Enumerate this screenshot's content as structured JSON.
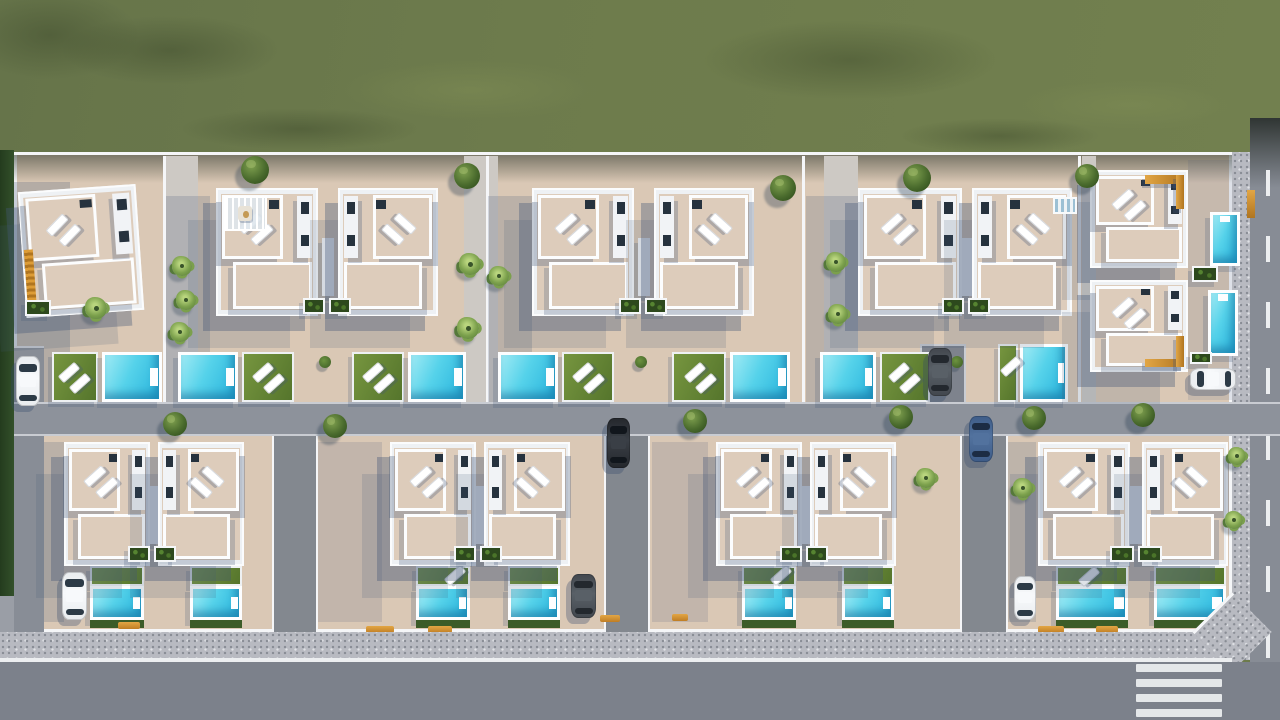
{
  "meta": {
    "title": "Aerial 3D architectural render of a residential villa development",
    "description": "Top-down render: green field above a walled plot with two rows of white villas, rooftop terraces with sun loungers, orange exterior stairs, planters, turquoise pools, lawns, internal roads, parked cars, perimeter sidewalk, asphalt road with zebra crosswalk at bottom right",
    "visible_text": ""
  },
  "palette": {
    "grass": "#6d7b4c",
    "grassDark": "rgba(40,52,28,0.32)",
    "grassLight": "rgba(126,140,84,0.55)",
    "plot": "#dac8b5",
    "wallWhite": "#f5f6f8",
    "villaWhite": "#eef1f4",
    "terrace": "#ddccbb",
    "darkSlot": "#26323e",
    "roadMid": "#8d929b",
    "roadAlley": "#83888f",
    "roadMain": "#7c818b",
    "roadRight": "#878c95",
    "roadLeft": "#888d96",
    "sidewalk": "#b8bac1",
    "curb": "#c9ccd2",
    "whiteLine": "#eceef0",
    "poolLight": "#9feaf4",
    "poolMid": "#55d2ea",
    "poolDeep": "#28b3dc",
    "lawnLight": "#76953f",
    "lawnDark": "#55752c",
    "hedge": "#33502a",
    "hedgeRow": "#3c5c28",
    "orange": "#dd9c36",
    "orangeDark": "#b07520",
    "planter": "#2d491d",
    "planterDot": "#568431",
    "castShadow": "rgba(66,86,120,0.36)",
    "castShadowFar": "rgba(66,86,120,0.17)",
    "softShadow": "rgba(66,86,120,0.22)",
    "treeRoundIn": "#7fa04f",
    "treeRoundOut": "#32501d",
    "palmIn": "#b9d57e",
    "palmMid": "#7ba04c",
    "palmOut": "#55793a",
    "cars": {
      "white": [
        "#e9ecef",
        "#f7f9fb",
        "#2c3a46"
      ],
      "black": [
        "#24272c",
        "#3a3f46",
        "#11161c"
      ],
      "blue": [
        "#3e5c88",
        "#52729e",
        "#1c2c44"
      ],
      "darkgray": [
        "#42474e",
        "#596067",
        "#23282e"
      ]
    }
  },
  "scene": {
    "grass": {
      "x": 0,
      "y": 0,
      "w": 1280,
      "h": 168
    },
    "grass_blotches": [
      [
        60,
        15,
        220,
        70,
        "d"
      ],
      [
        340,
        60,
        260,
        60,
        "l"
      ],
      [
        700,
        20,
        300,
        80,
        "d"
      ],
      [
        1020,
        80,
        220,
        50,
        "l"
      ],
      [
        180,
        108,
        240,
        42,
        "d"
      ],
      [
        900,
        118,
        200,
        36,
        "d"
      ],
      [
        -40,
        -10,
        180,
        90,
        "d"
      ]
    ],
    "right_road": {
      "x": 1250,
      "y": 118,
      "w": 30,
      "h": 602
    },
    "right_road_dashes": {
      "x": 1266,
      "w": 4,
      "len": 26,
      "gap": 40,
      "y0": 170,
      "y1": 640
    },
    "right_sidewalk": {
      "x": 1232,
      "y": 152,
      "w": 18,
      "h": 480
    },
    "left_hedge": {
      "x": 0,
      "y": 150,
      "w": 14,
      "h": 446
    },
    "left_below": {
      "x": 0,
      "y": 596,
      "w": 14,
      "h": 40
    },
    "plot": {
      "x": 14,
      "y": 152,
      "w": 1218,
      "h": 480
    },
    "divider_walls": [
      [
        163,
        156,
        3,
        246
      ],
      [
        486,
        156,
        3,
        246
      ],
      [
        802,
        156,
        3,
        246
      ],
      [
        1078,
        156,
        3,
        246
      ]
    ],
    "pavements": [
      [
        166,
        156,
        32,
        246
      ],
      [
        464,
        156,
        34,
        246
      ],
      [
        824,
        156,
        34,
        246
      ],
      [
        1082,
        156,
        14,
        246
      ]
    ],
    "shadow_rects": [
      [
        14,
        182,
        56,
        224,
        0.25
      ],
      [
        166,
        196,
        44,
        206,
        0.2
      ],
      [
        488,
        196,
        44,
        206,
        0.2
      ],
      [
        806,
        196,
        52,
        206,
        0.2
      ],
      [
        44,
        442,
        20,
        180,
        0.2
      ],
      [
        318,
        442,
        64,
        180,
        0.16
      ],
      [
        652,
        442,
        56,
        180,
        0.16
      ],
      [
        1008,
        442,
        28,
        180,
        0.18
      ],
      [
        14,
        402,
        500,
        34,
        0.15
      ],
      [
        1188,
        160,
        44,
        240,
        0.13
      ]
    ],
    "left_road": {
      "x": 14,
      "y": 346,
      "w": 30,
      "h": 286
    },
    "mid_road": {
      "x": 14,
      "y": 402,
      "w": 1266,
      "h": 34
    },
    "alleys": [
      [
        272,
        436,
        46,
        196
      ],
      [
        604,
        436,
        46,
        196
      ],
      [
        960,
        436,
        48,
        196
      ]
    ],
    "parking_pad": {
      "x": 920,
      "y": 344,
      "w": 46,
      "h": 60
    },
    "lawns": [
      [
        52,
        352,
        46,
        50
      ],
      [
        242,
        352,
        52,
        50
      ],
      [
        352,
        352,
        52,
        50
      ],
      [
        562,
        352,
        52,
        50
      ],
      [
        672,
        352,
        54,
        50
      ],
      [
        880,
        352,
        50,
        50
      ],
      [
        998,
        344,
        20,
        58
      ],
      [
        90,
        566,
        54,
        20
      ],
      [
        190,
        566,
        52,
        20
      ],
      [
        416,
        566,
        54,
        20
      ],
      [
        508,
        566,
        52,
        20
      ],
      [
        742,
        566,
        54,
        20
      ],
      [
        842,
        566,
        52,
        20
      ],
      [
        1056,
        566,
        72,
        20
      ],
      [
        1154,
        566,
        72,
        20
      ]
    ],
    "pools": [
      [
        102,
        352,
        60,
        50,
        "h"
      ],
      [
        178,
        352,
        60,
        50,
        "h"
      ],
      [
        408,
        352,
        58,
        50,
        "h"
      ],
      [
        498,
        352,
        60,
        50,
        "h"
      ],
      [
        730,
        352,
        60,
        50,
        "h"
      ],
      [
        820,
        352,
        56,
        50,
        "h"
      ],
      [
        1020,
        344,
        48,
        58,
        "h"
      ],
      [
        1210,
        212,
        30,
        54,
        "v"
      ],
      [
        1208,
        290,
        30,
        66,
        "v"
      ],
      [
        90,
        586,
        54,
        34,
        "h"
      ],
      [
        190,
        586,
        52,
        34,
        "h"
      ],
      [
        416,
        586,
        54,
        34,
        "h"
      ],
      [
        508,
        586,
        52,
        34,
        "h"
      ],
      [
        742,
        586,
        54,
        34,
        "h"
      ],
      [
        842,
        586,
        52,
        34,
        "h"
      ],
      [
        1056,
        586,
        72,
        34,
        "h"
      ],
      [
        1154,
        586,
        72,
        34,
        "h"
      ]
    ],
    "pool_hedges": [
      [
        90,
        620,
        54,
        8
      ],
      [
        190,
        620,
        52,
        8
      ],
      [
        416,
        620,
        54,
        8
      ],
      [
        508,
        620,
        52,
        8
      ],
      [
        742,
        620,
        54,
        8
      ],
      [
        842,
        620,
        52,
        8
      ],
      [
        1056,
        620,
        72,
        8
      ],
      [
        1154,
        620,
        72,
        8
      ]
    ],
    "lawn_loungers": [
      [
        58,
        366,
        2
      ],
      [
        252,
        366,
        2
      ],
      [
        362,
        366,
        2
      ],
      [
        572,
        366,
        2
      ],
      [
        684,
        366,
        2
      ],
      [
        888,
        366,
        2
      ],
      [
        1000,
        360,
        1
      ],
      [
        444,
        569,
        1
      ],
      [
        770,
        569,
        1
      ],
      [
        1078,
        570,
        1
      ]
    ],
    "villas": [
      {
        "id": "villa-a",
        "x": 22,
        "y": 188,
        "w": 118,
        "h": 126,
        "v": "left",
        "rot": -4,
        "opt": "orange-left"
      },
      {
        "id": "villa-b1",
        "x": 216,
        "y": 188,
        "w": 102,
        "h": 128,
        "v": "left",
        "opt": "pergola"
      },
      {
        "id": "villa-b2",
        "x": 338,
        "y": 188,
        "w": 100,
        "h": 128,
        "v": "right"
      },
      {
        "id": "villa-c1",
        "x": 532,
        "y": 188,
        "w": 102,
        "h": 128,
        "v": "left"
      },
      {
        "id": "villa-c2",
        "x": 654,
        "y": 188,
        "w": 100,
        "h": 128,
        "v": "right"
      },
      {
        "id": "villa-d1",
        "x": 858,
        "y": 188,
        "w": 104,
        "h": 128,
        "v": "left"
      },
      {
        "id": "villa-d2",
        "x": 972,
        "y": 188,
        "w": 100,
        "h": 128,
        "v": "right"
      },
      {
        "id": "villa-r1",
        "x": 1090,
        "y": 170,
        "w": 98,
        "h": 98,
        "v": "left",
        "opt": "orange-tr"
      },
      {
        "id": "villa-r2",
        "x": 1090,
        "y": 280,
        "w": 98,
        "h": 92,
        "v": "left",
        "opt": "orange-br"
      },
      {
        "id": "villa-l1a",
        "x": 64,
        "y": 442,
        "w": 86,
        "h": 124,
        "v": "left"
      },
      {
        "id": "villa-l1b",
        "x": 158,
        "y": 442,
        "w": 86,
        "h": 124,
        "v": "right"
      },
      {
        "id": "villa-l2a",
        "x": 390,
        "y": 442,
        "w": 86,
        "h": 124,
        "v": "left"
      },
      {
        "id": "villa-l2b",
        "x": 484,
        "y": 442,
        "w": 86,
        "h": 124,
        "v": "right"
      },
      {
        "id": "villa-l3a",
        "x": 716,
        "y": 442,
        "w": 86,
        "h": 124,
        "v": "left"
      },
      {
        "id": "villa-l3b",
        "x": 810,
        "y": 442,
        "w": 86,
        "h": 124,
        "v": "right"
      },
      {
        "id": "villa-l4a",
        "x": 1038,
        "y": 442,
        "w": 92,
        "h": 124,
        "v": "left"
      },
      {
        "id": "villa-l4b",
        "x": 1142,
        "y": 442,
        "w": 86,
        "h": 124,
        "v": "right"
      }
    ],
    "stairzones": [
      [
        307,
        238,
        42,
        58
      ],
      [
        623,
        238,
        42,
        58
      ],
      [
        946,
        238,
        42,
        58
      ],
      [
        133,
        486,
        42,
        58
      ],
      [
        459,
        486,
        42,
        58
      ],
      [
        785,
        486,
        42,
        58
      ],
      [
        1115,
        486,
        42,
        58
      ]
    ],
    "planters": [
      [
        303,
        298,
        22,
        16
      ],
      [
        329,
        298,
        22,
        16
      ],
      [
        619,
        298,
        22,
        16
      ],
      [
        645,
        298,
        22,
        16
      ],
      [
        942,
        298,
        22,
        16
      ],
      [
        968,
        298,
        22,
        16
      ],
      [
        1192,
        266,
        26,
        16
      ],
      [
        1190,
        352,
        22,
        12
      ],
      [
        128,
        546,
        22,
        16
      ],
      [
        154,
        546,
        22,
        16
      ],
      [
        454,
        546,
        22,
        16
      ],
      [
        480,
        546,
        22,
        16
      ],
      [
        780,
        546,
        22,
        16
      ],
      [
        806,
        546,
        22,
        16
      ],
      [
        1110,
        546,
        24,
        16
      ],
      [
        1138,
        546,
        24,
        16
      ],
      [
        25,
        300,
        26,
        16
      ]
    ],
    "misc_stair": {
      "x": 1053,
      "y": 197,
      "w": 24,
      "h": 17
    },
    "orange_gate": {
      "x": 1247,
      "y": 190,
      "w": 8,
      "h": 28
    },
    "trees": [
      [
        "r",
        255,
        170,
        14
      ],
      [
        "r",
        467,
        176,
        13
      ],
      [
        "r",
        783,
        188,
        13
      ],
      [
        "r",
        917,
        178,
        14
      ],
      [
        "r",
        1087,
        176,
        12
      ],
      [
        "r",
        175,
        424,
        12
      ],
      [
        "r",
        335,
        426,
        12
      ],
      [
        "r",
        695,
        421,
        12
      ],
      [
        "r",
        901,
        417,
        12
      ],
      [
        "r",
        1034,
        418,
        12
      ],
      [
        "r",
        1143,
        415,
        12
      ],
      [
        "p",
        96,
        308,
        11
      ],
      [
        "p",
        182,
        266,
        10
      ],
      [
        "p",
        186,
        300,
        10
      ],
      [
        "p",
        180,
        332,
        10
      ],
      [
        "p",
        470,
        264,
        11
      ],
      [
        "p",
        499,
        276,
        10
      ],
      [
        "p",
        468,
        328,
        11
      ],
      [
        "p",
        836,
        262,
        10
      ],
      [
        "p",
        838,
        314,
        10
      ],
      [
        "p",
        926,
        478,
        10
      ],
      [
        "p",
        1023,
        488,
        10
      ],
      [
        "p",
        1237,
        456,
        9
      ],
      [
        "p",
        1234,
        520,
        9
      ],
      [
        "s",
        325,
        362,
        6
      ],
      [
        "s",
        641,
        362,
        6
      ],
      [
        "s",
        957,
        362,
        6
      ]
    ],
    "cars": [
      {
        "id": "car-white-left-road",
        "x": 16,
        "y": 356,
        "w": 24,
        "h": 50,
        "c": "white",
        "dir": "v"
      },
      {
        "id": "car-white-lower-left",
        "x": 62,
        "y": 572,
        "w": 25,
        "h": 48,
        "c": "white",
        "dir": "v"
      },
      {
        "id": "car-black-mid-alley",
        "x": 607,
        "y": 418,
        "w": 23,
        "h": 50,
        "c": "black",
        "dir": "v"
      },
      {
        "id": "car-gray-parking-pad",
        "x": 928,
        "y": 348,
        "w": 24,
        "h": 48,
        "c": "darkgray",
        "dir": "v"
      },
      {
        "id": "car-blue-right-alley",
        "x": 969,
        "y": 416,
        "w": 24,
        "h": 46,
        "c": "blue",
        "dir": "v"
      },
      {
        "id": "car-white-right-block",
        "x": 1190,
        "y": 368,
        "w": 46,
        "h": 22,
        "c": "white",
        "dir": "h"
      },
      {
        "id": "car-white-lower-l4",
        "x": 1014,
        "y": 576,
        "w": 22,
        "h": 44,
        "c": "white",
        "dir": "v"
      },
      {
        "id": "car-gray-lower-mid",
        "x": 571,
        "y": 574,
        "w": 25,
        "h": 44,
        "c": "darkgray",
        "dir": "v"
      }
    ],
    "flowerbeds": [
      [
        118,
        622,
        22,
        7
      ],
      [
        366,
        626,
        28,
        7
      ],
      [
        428,
        626,
        24,
        7
      ],
      [
        600,
        615,
        20,
        7
      ],
      [
        672,
        614,
        16,
        7
      ],
      [
        1038,
        626,
        26,
        7
      ],
      [
        1096,
        626,
        22,
        7
      ]
    ],
    "bottom_sidewalk": {
      "x": 0,
      "y": 632,
      "w": 1250,
      "h": 28
    },
    "white_line": {
      "x": 0,
      "y": 658,
      "w": 1232,
      "h": 4
    },
    "bottom_road": {
      "x": 0,
      "y": 662,
      "w": 1280,
      "h": 58
    },
    "crosswalk": {
      "x": 1136,
      "w": 86,
      "ys": [
        664,
        679,
        694,
        709
      ],
      "h": 8
    },
    "corner_chamfer": {
      "x": 1204,
      "y": 604,
      "size": 56
    },
    "top_wall_shadow": {
      "x": 14,
      "y": 155,
      "w": 1218,
      "h": 28
    }
  }
}
